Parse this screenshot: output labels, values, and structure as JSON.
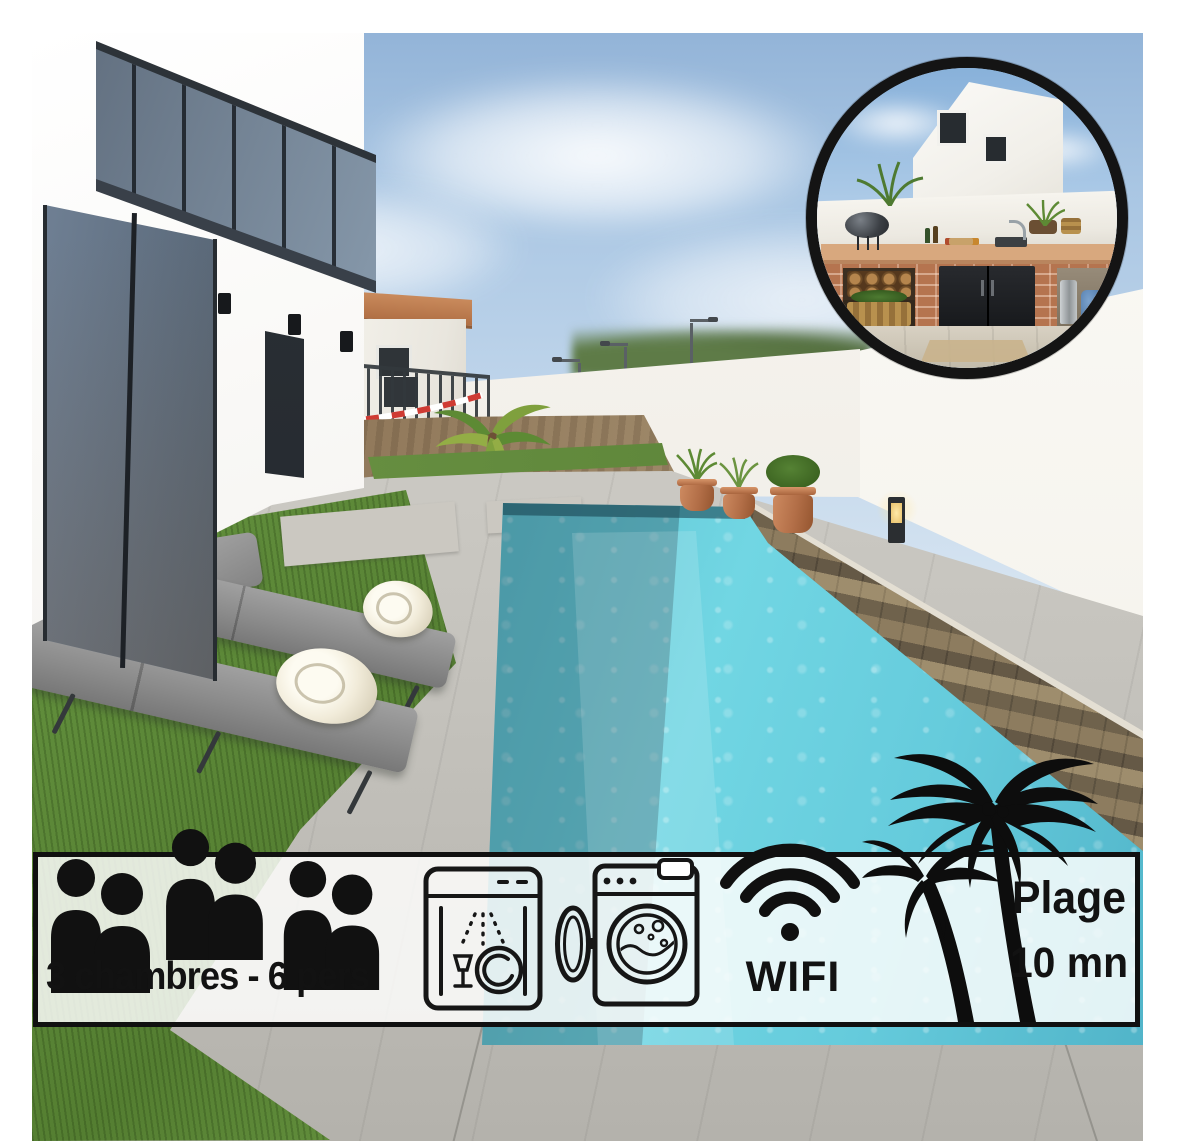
{
  "banner": {
    "capacity": {
      "label": "3 chambres - 6 pers",
      "icon": "people-pair-icon",
      "people_pairs": 3,
      "people_total": 6
    },
    "appliances": {
      "icons": [
        "dishwasher-icon",
        "washing-machine-icon"
      ]
    },
    "wifi": {
      "label": "WIFI",
      "icon": "wifi-icon"
    },
    "beach": {
      "line1": "Plage",
      "line2": "10 mn",
      "icon": "palm-trees-icon"
    }
  },
  "inset_photo": {
    "subject": "outdoor-kitchen",
    "shape": "circle",
    "border_color": "#141414"
  },
  "main_photo": {
    "subject": "villa-with-pool",
    "elements": [
      "modern-white-house",
      "sliding-glass-door",
      "glass-balcony",
      "swimming-pool",
      "stone-coping",
      "sun-loungers",
      "rolled-towels",
      "terracotta-pots",
      "boundary-wall",
      "neighbour-house",
      "garden-palm",
      "lawn",
      "dirt-patch",
      "street-lamps",
      "bollard-lamp",
      "safety-tape",
      "metal-fence"
    ]
  },
  "colors": {
    "frame": "#ffffff",
    "ink": "#121212",
    "banner_bg": "#fefefd",
    "pool_water": "#5cbfcf",
    "sky": "#a9c6e3",
    "grass": "#618e3c",
    "wall": "#f6f4ee",
    "terracotta": "#b5744f",
    "stone_coping": "#84765f",
    "roof_tile": "#c98a5c"
  }
}
